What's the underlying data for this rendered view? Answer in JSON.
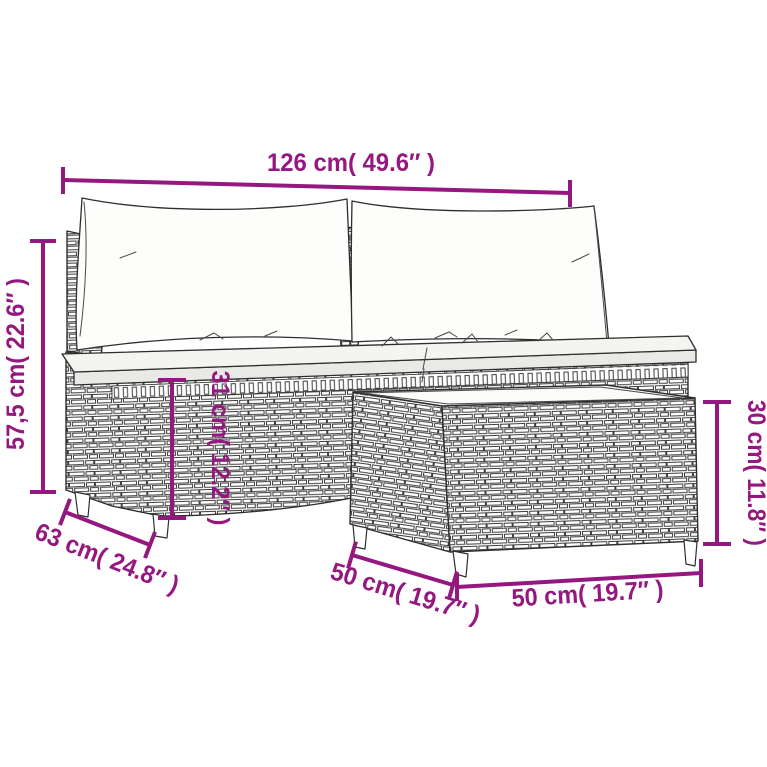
{
  "page": {
    "background": "#ffffff"
  },
  "diagram": {
    "accent_color": "#951780",
    "outline_color": "#2e2e2e",
    "dimensions": {
      "total_width": {
        "label": "126 cm( 49.6″ )"
      },
      "total_height": {
        "label": "57,5 cm( 22.6″ )"
      },
      "base_height": {
        "label": "31 cm( 12.2″ )"
      },
      "table_height": {
        "label": "30 cm( 11.8″ )"
      },
      "sofa_depth": {
        "label": "63 cm( 24.8″ )"
      },
      "table_depth": {
        "label": "50 cm( 19.7″ )"
      },
      "table_width": {
        "label": "50 cm( 19.7″ )"
      }
    }
  }
}
